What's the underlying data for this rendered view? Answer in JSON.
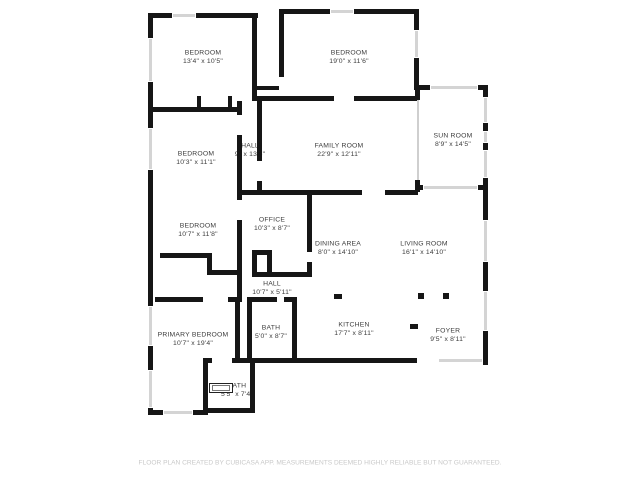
{
  "floor_plan": {
    "rooms": [
      {
        "name": "BEDROOM",
        "dims": "13'4\" x 10'5\""
      },
      {
        "name": "BEDROOM",
        "dims": "19'0\" x 11'6\""
      },
      {
        "name": "BEDROOM",
        "dims": "10'3\" x 11'1\""
      },
      {
        "name": "HALL",
        "dims": "9\" x 13'8\""
      },
      {
        "name": "FAMILY ROOM",
        "dims": "22'9\" x 12'11\""
      },
      {
        "name": "SUN ROOM",
        "dims": "8'9\" x 14'5\""
      },
      {
        "name": "BEDROOM",
        "dims": "10'7\" x 11'8\""
      },
      {
        "name": "OFFICE",
        "dims": "10'3\" x 8'7\""
      },
      {
        "name": "DINING AREA",
        "dims": "8'0\" x 14'10\""
      },
      {
        "name": "LIVING ROOM",
        "dims": "16'1\" x 14'10\""
      },
      {
        "name": "HALL",
        "dims": "10'7\" x 5'11\""
      },
      {
        "name": "BATH",
        "dims": "5'0\" x 8'7\""
      },
      {
        "name": "KITCHEN",
        "dims": "17'7\" x 8'11\""
      },
      {
        "name": "FOYER",
        "dims": "9'5\" x 8'11\""
      },
      {
        "name": "PRIMARY BEDROOM",
        "dims": "10'7\" x 19'4\""
      },
      {
        "name": "BATH",
        "dims": "5'5\" x 7'4\""
      }
    ],
    "footer": "FLOOR PLAN CREATED BY CUBICASA APP. MEASUREMENTS DEEMED HIGHLY RELIABLE BUT NOT GUARANTEED.",
    "colors": {
      "wall": "#161616",
      "window": "#d4d4d4",
      "glass": "#cfcfcf",
      "label_text": "#3d3d3d",
      "footer_text": "#c9c9c9"
    }
  }
}
